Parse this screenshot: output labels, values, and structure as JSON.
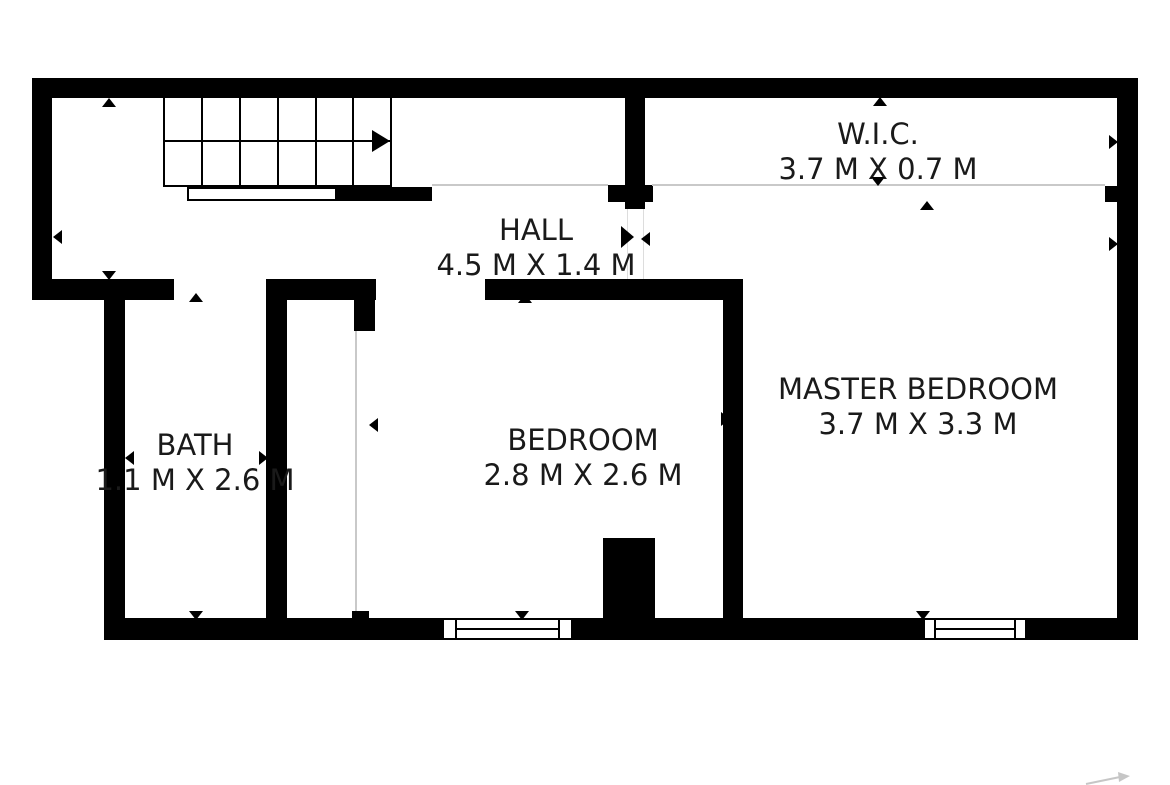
{
  "rooms": {
    "hall": {
      "name": "HALL",
      "dimensions": "4.5 M X 1.4 M"
    },
    "wic": {
      "name": "W.I.C.",
      "dimensions": "3.7 M X 0.7 M"
    },
    "bath": {
      "name": "BATH",
      "dimensions": "1.1 M X 2.6 M"
    },
    "bedroom": {
      "name": "BEDROOM",
      "dimensions": "2.8 M X 2.6 M"
    },
    "master_bedroom": {
      "name": "MASTER BEDROOM",
      "dimensions": "3.7 M X 3.3 M"
    }
  },
  "stairs": {
    "tread_columns": 6,
    "direction": "right"
  },
  "units": "M",
  "colors": {
    "wall": "#000000",
    "text": "#1a1a1a",
    "faint_line": "#c9c9c9",
    "background": "#ffffff"
  }
}
